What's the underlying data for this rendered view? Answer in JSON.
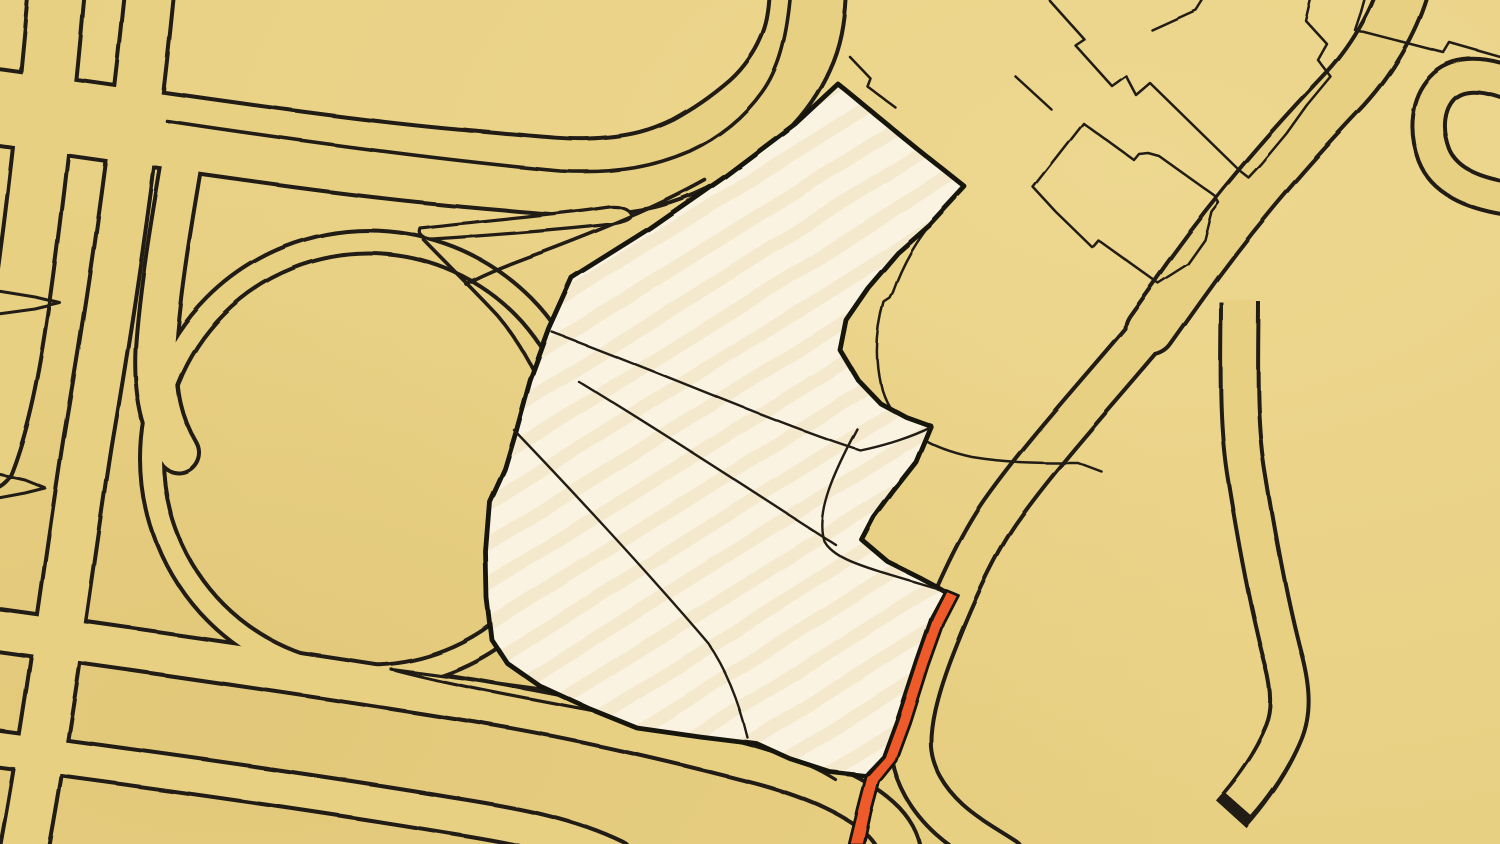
{
  "meta": {
    "type": "hand-drawn-map",
    "description": "Hand-drawn ink-on-paper style city map with a highlighted development parcel, highway interchange, loop road and an orange route stripe"
  },
  "map": {
    "colors": {
      "background": "#E8D083",
      "background_light": "#F2DE97",
      "background_shade": "#DFC577",
      "ink": "#201C12",
      "ink_heavy": "#15120B",
      "parcel_fill": "#FAF3E2",
      "parcel_texture": "#EFE0BA",
      "route_stripe": "#EF5A2B"
    },
    "features": {
      "interchange": "highway interchange with parallel carriageways",
      "curved_highway": "multi-line highway sweeping from top edge to left edge",
      "loop_road": "large circular loop ramp",
      "parcel": "highlighted cream parcel with subdivision lines",
      "buildings": "thin outlined building footprints",
      "route": "orange highlighted route segment",
      "dead_end": "road ending in closed stub"
    }
  }
}
